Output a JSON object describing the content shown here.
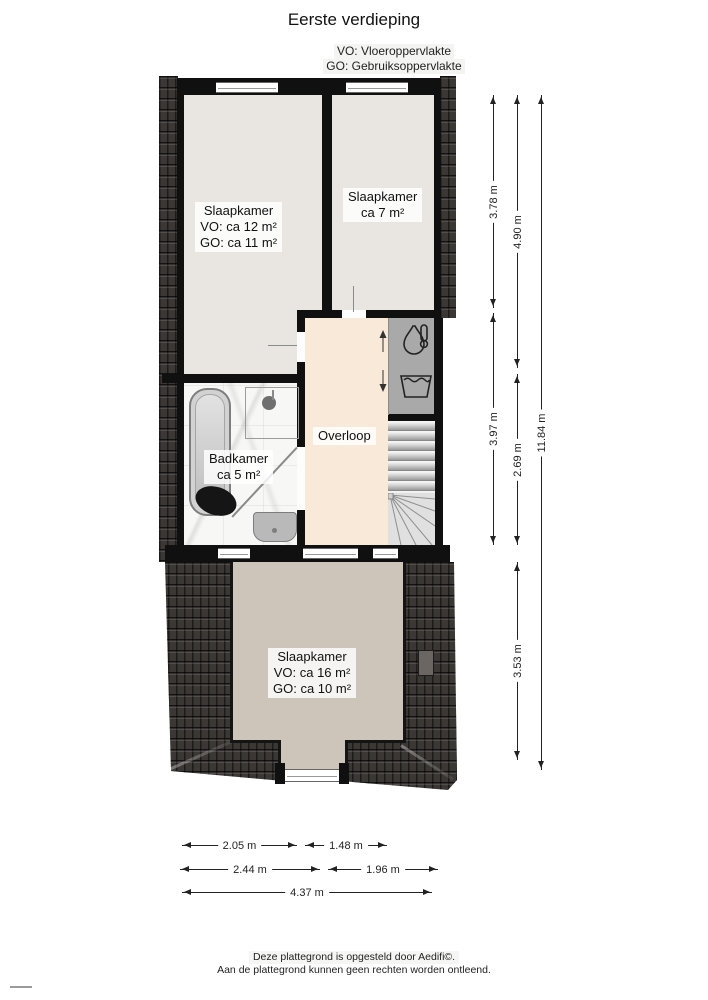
{
  "page": {
    "title": "Eerste verdieping",
    "legend": {
      "vo": "VO: Vloeroppervlakte",
      "go": "GO: Gebruiksoppervlakte"
    },
    "footer": {
      "line1": "Deze plattegrond is opgesteld door Aedifi©.",
      "line2": "Aan de plattegrond kunnen geen rechten worden ontleend."
    }
  },
  "rooms": {
    "bedroom_left": {
      "name": "Slaapkamer",
      "vo": "VO: ca 12 m²",
      "go": "GO: ca 11 m²"
    },
    "bedroom_right": {
      "name": "Slaapkamer",
      "size": "ca 7 m²"
    },
    "bathroom": {
      "name": "Badkamer",
      "size": "ca 5 m²"
    },
    "landing": {
      "name": "Overloop"
    },
    "bedroom_bottom": {
      "name": "Slaapkamer",
      "vo": "VO: ca 16 m²",
      "go": "GO: ca 10 m²"
    }
  },
  "dimensions": {
    "vertical": [
      "3.78 m",
      "3.97 m",
      "4.90 m",
      "2.69 m",
      "3.53 m",
      "11.84 m"
    ],
    "horizontal": [
      "2.05 m",
      "1.48 m",
      "2.44 m",
      "1.96 m",
      "4.37 m"
    ]
  },
  "icons": {
    "boiler": "water-heater-icon",
    "laundry": "laundry-tub-icon",
    "stairs_up_arrow": "up",
    "stairs_down_arrow": "down"
  },
  "colors": {
    "wall": "#101010",
    "roof": "#3b3734",
    "floor_bedroom_top": "#e9e6e1",
    "floor_landing": "#f8e9d8",
    "floor_bedroom_bottom": "#cdc4ba",
    "utility_gray": "#a9a9a9",
    "dimension_text": "#222222"
  }
}
